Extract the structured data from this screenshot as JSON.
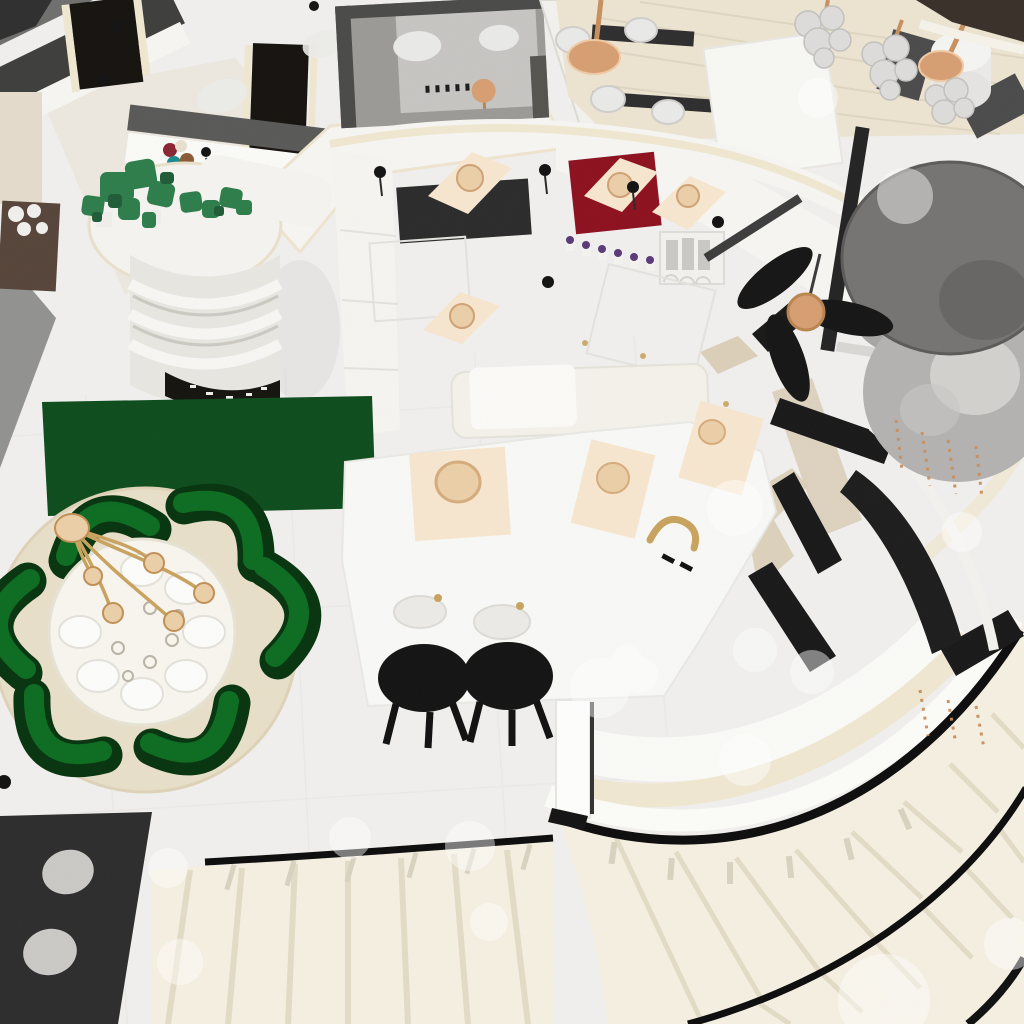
{
  "scene": {
    "title": "Overhead 3D render of a two-storey luxury interior",
    "view": "bird's-eye / top-down render, no UI chrome, no visible text",
    "style": "white and cream interior with emerald green, copper and black accents",
    "areas": [
      {
        "name": "dining-area",
        "items": [
          "round white dining table",
          "six white place settings with glassware",
          "copper branch chandelier",
          "six emerald curved armchairs",
          "round cream rug",
          "dark green rectangular runner rug"
        ]
      },
      {
        "name": "kitchen",
        "items": [
          "white island with curved front apron",
          "three cream placemats with copper candle bowls",
          "copper faucet",
          "two black bar stools",
          "dark wall panel",
          "crimson wall mat",
          "cream hood drapes",
          "row of six potted purple flowers",
          "arched canister shelf",
          "black candle sconces",
          "brass cabinet knobs"
        ]
      },
      {
        "name": "stair-hall",
        "items": [
          "grand curved staircase with cream treads",
          "black handrails",
          "white balustrade",
          "straight lower flight",
          "charcoal rug with light dots",
          "white newel post",
          "downlight glare circles"
        ]
      },
      {
        "name": "mezzanine-cafe",
        "items": [
          "cream plank floor",
          "two copper pendant discs",
          "white shell chairs",
          "white cylinder table",
          "grey benches",
          "glass bubble chandeliers",
          "dark brown cornice band"
        ]
      },
      {
        "name": "upper-left-rooms",
        "items": [
          "grey roof terrace with copper stool",
          "dark door openings",
          "rounded display tower with shelves",
          "green pixel plants",
          "coloured vases",
          "brown dresser with white spheres"
        ]
      },
      {
        "name": "fixtures",
        "items": [
          "black three-blade ceiling fan with copper hub",
          "large silver drum pendant lamp",
          "black glass railing panels",
          "copper crystal strands",
          "window mullions"
        ]
      }
    ]
  },
  "palette": {
    "floor": "#f0efed",
    "tile_line": "#cfcecb",
    "wall_white": "#f6f5f1",
    "ivory_trim": "#efe7d0",
    "wall_gray": "#929290",
    "wall_dark": "#3e3e3c",
    "roof_gray": "#9b9a97",
    "roof_light": "#c6c5c2",
    "door_dark": "#16130f",
    "dresser_brown": "#57453a",
    "green_rug": "#0e4d1d",
    "chair_green": "#0e6f24",
    "chair_green_dark": "#07350f",
    "plant_green": "#2e7d4b",
    "cream_rug": "#e8dfc9",
    "table_white": "#f7f5ee",
    "charcoal_rug": "#2d2d2d",
    "rug_dot": "#cac9c5",
    "stair_tread": "#f4efe1",
    "stair_line": "#e2dbc5",
    "rail_black": "#0d0d0d",
    "balustrade_white": "#fbfbf8",
    "copper": "#d79e72",
    "gold": "#c9a35f",
    "placemat": "#f7e6cf",
    "candle": "#eacfa8",
    "red_mat": "#8e1120",
    "dark_panel": "#2b2b2b",
    "silver_body": "#b3b2b0",
    "silver_top": "#757472",
    "bench_gray": "#4b4b4b",
    "wood_floor": "#ece4d1",
    "brown_band": "#39302a",
    "glass_bubble": "#dddcda",
    "stool_black": "#141414",
    "beige_patch": "#d8cbb2",
    "glare": "#ffffff",
    "teal_vase": "#1b8a8f",
    "red_vase": "#8c2633",
    "tan_vase": "#8a5a33",
    "purple_flower": "#5a3a78"
  }
}
